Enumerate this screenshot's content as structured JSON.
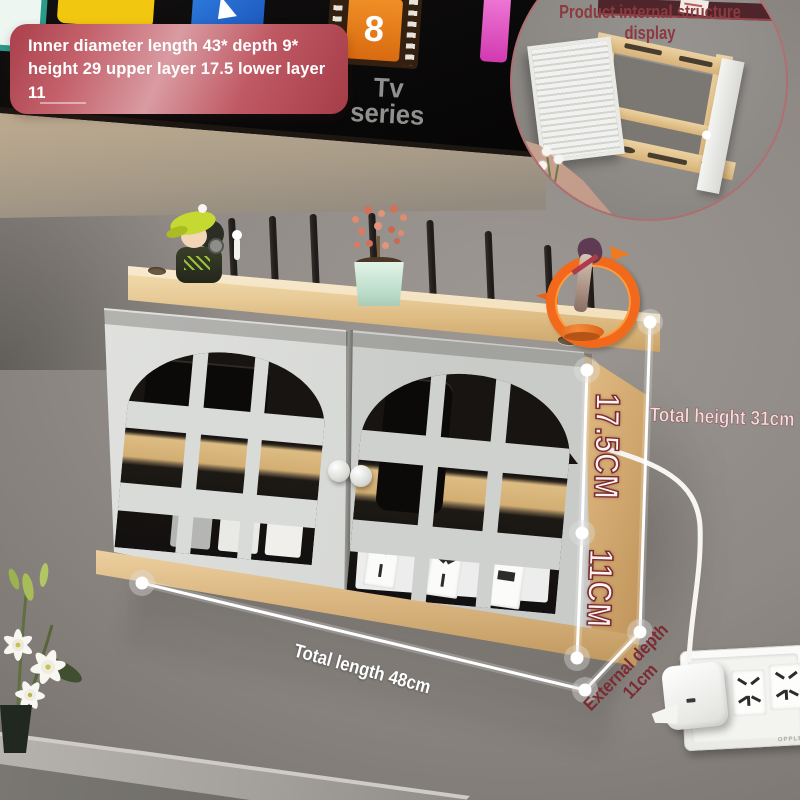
{
  "badge": {
    "text": "Inner diameter length 43* depth 9* height 29 upper layer 17.5 lower layer 11"
  },
  "tv": {
    "series_label_line1": "Tv",
    "series_label_line2": "series",
    "film_tile_number": "8"
  },
  "inset": {
    "title_line1": "Product internal structure",
    "title_line2": "display"
  },
  "measurements": {
    "upper_section": "17.5CM",
    "lower_section": "11CM",
    "total_height": "Total height 31cm",
    "total_length": "Total length 48cm",
    "external_depth_line1": "External depth",
    "external_depth_line2": "11cm"
  },
  "wall_socket": {
    "brand": "OPPLE"
  },
  "colors": {
    "annotation_red": "#7c2b33",
    "annotation_white": "#ffffff",
    "badge_bg": "#b8515c",
    "inset_title_red": "#8c3a40",
    "wood": "#e0bd85",
    "door_gray": "#d6d8d6"
  }
}
